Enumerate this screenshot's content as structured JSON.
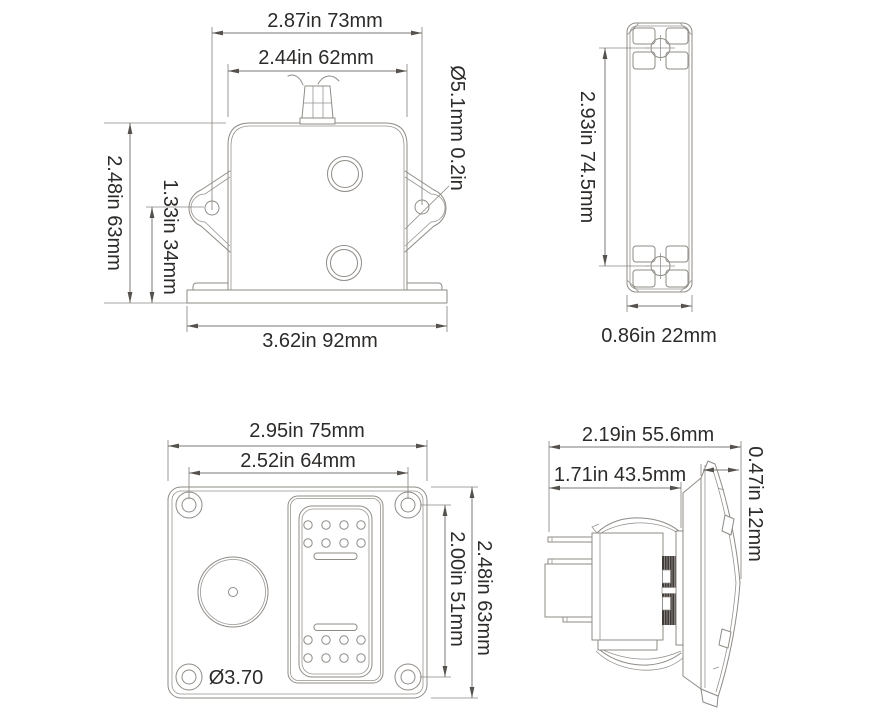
{
  "drawing": {
    "background": "#ffffff",
    "colors": {
      "line": "#8f8b86",
      "dimension_line": "#7c7975",
      "arrow": "#55514d",
      "text": "#2d2b29",
      "knurl_dark": "#3f3b38"
    },
    "views": {
      "bracket_front": {
        "name": "switch housing front view with mounting ears",
        "ear_hole_spacing": "2.87in 73mm",
        "body_width": "2.44in 62mm",
        "overall_height": "2.48in 63mm",
        "hole_to_base_height": "1.33in 34mm",
        "base_width": "3.62in 92mm",
        "ear_hole_diameter": "Ø5.1mm 0.2in"
      },
      "bracket_side": {
        "name": "housing side profile view",
        "height": "2.93in 74.5mm",
        "width": "0.86in 22mm"
      },
      "panel_front": {
        "name": "switch panel face view",
        "width": "2.95in 75mm",
        "screw_spacing_width": "2.52in 64mm",
        "screw_spacing_height": "2.00in 51mm",
        "height": "2.48in 63mm",
        "screw_hole_diameter": "Ø3.70"
      },
      "switch_side": {
        "name": "rocker switch side profile view",
        "total_depth": "2.19in 55.6mm",
        "body_depth": "1.71in 43.5mm",
        "bezel_depth": "0.47in 12mm"
      }
    }
  }
}
